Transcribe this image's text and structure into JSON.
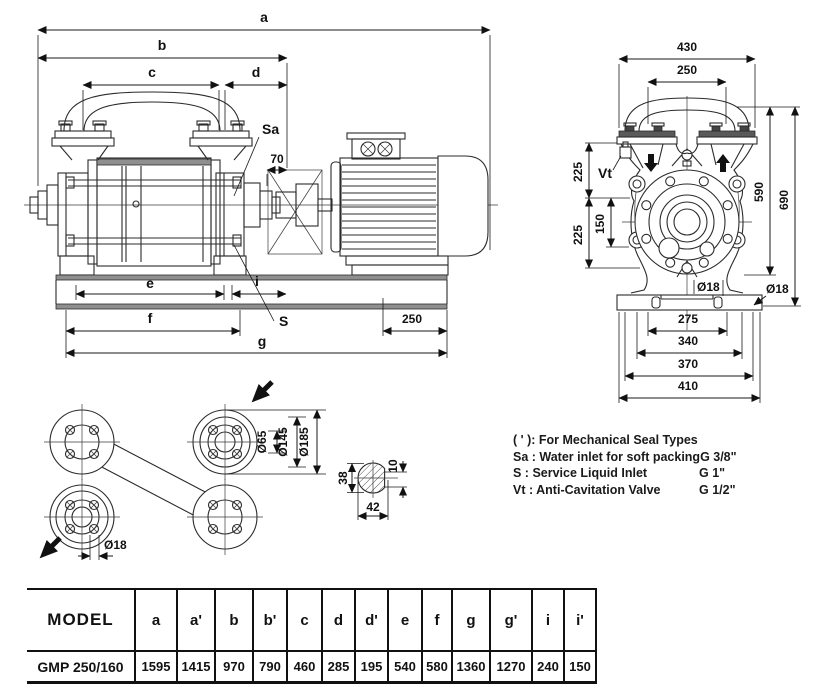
{
  "drawing": {
    "side": {
      "a": "a",
      "b": "b",
      "c": "c",
      "d": "d",
      "e": "e",
      "f": "f",
      "g": "g",
      "i": "i",
      "sa": "Sa",
      "s": "S",
      "n70": "70",
      "n250": "250"
    },
    "front": {
      "n430": "430",
      "n250": "250",
      "n225_top": "225",
      "n225_bot": "225",
      "n150": "150",
      "n590": "590",
      "n690": "690",
      "n275": "275",
      "n340": "340",
      "n370": "370",
      "n410": "410",
      "d18_slot": "Ø18",
      "d18_edge": "Ø18",
      "vt": "Vt"
    },
    "flange": {
      "d65": "Ø65",
      "d145": "Ø145",
      "d185": "Ø185",
      "d18": "Ø18"
    },
    "shaft": {
      "n38": "38",
      "n42": "42",
      "n10": "10"
    }
  },
  "legend": {
    "rows": [
      {
        "label": "( ' ): For Mechanical Seal Types",
        "value": ""
      },
      {
        "label": "Sa : Water inlet for soft packing",
        "value": "G 3/8\""
      },
      {
        "label": "S  : Service Liquid Inlet",
        "value": "G 1\""
      },
      {
        "label": "Vt : Anti-Cavitation Valve",
        "value": "G 1/2\""
      }
    ]
  },
  "table": {
    "headers": [
      "MODEL",
      "a",
      "a'",
      "b",
      "b'",
      "c",
      "d",
      "d'",
      "e",
      "f",
      "g",
      "g'",
      "i",
      "i'"
    ],
    "row_model": "GMP 250/160",
    "row_values": [
      "1595",
      "1415",
      "970",
      "790",
      "460",
      "285",
      "195",
      "540",
      "580",
      "1360",
      "1270",
      "240",
      "150"
    ]
  }
}
